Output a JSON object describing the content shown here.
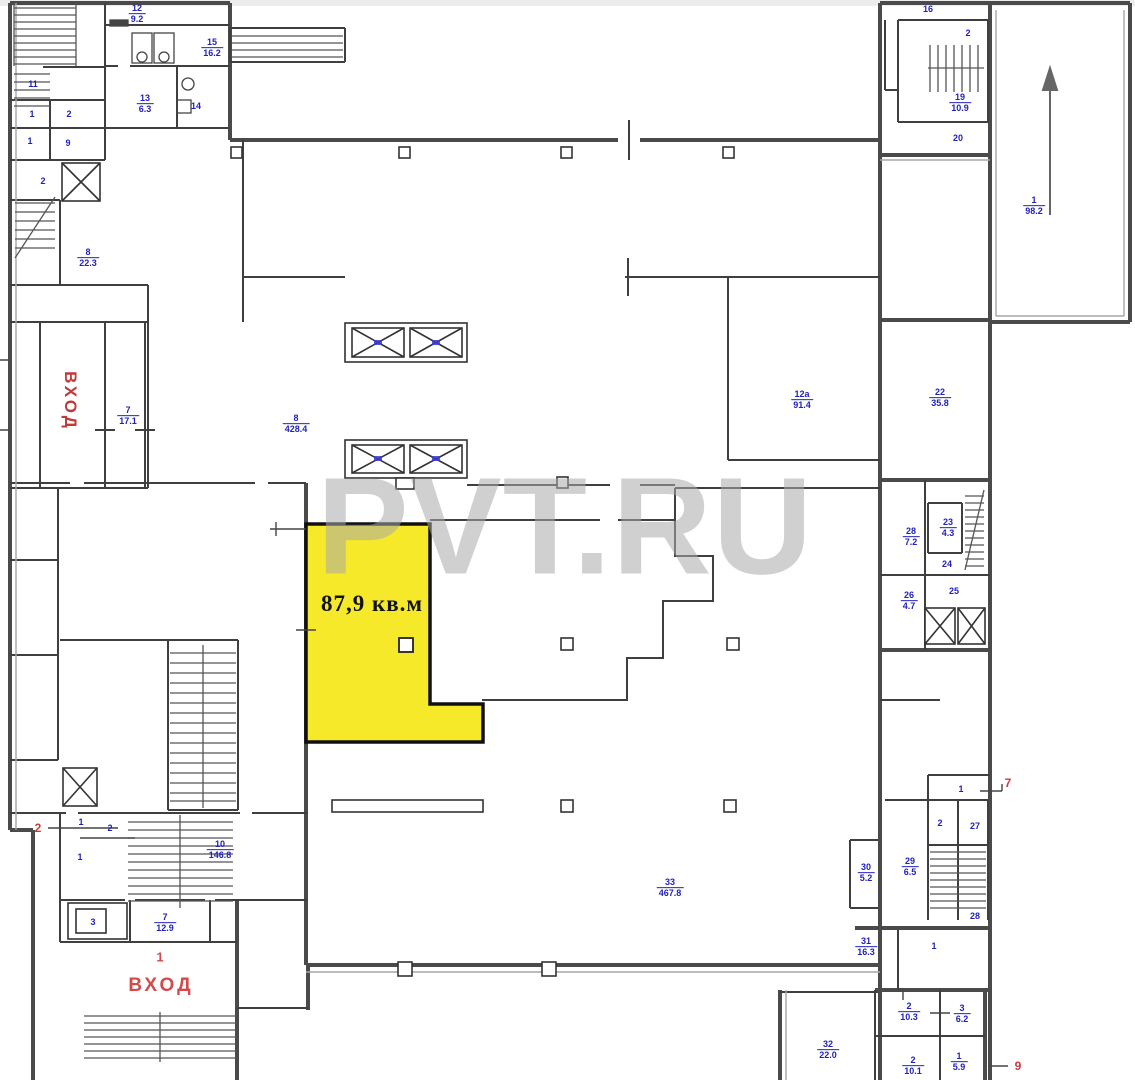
{
  "watermark": {
    "text": "PVT.RU"
  },
  "unit": {
    "area_label": "87,9 кв.м"
  },
  "entrances": {
    "side_label": "ВХОД",
    "main_number": "1",
    "main_label": "ВХОД"
  },
  "colors": {
    "highlight_yellow": "#f5e929",
    "label_blue": "#2222bb",
    "marker_red": "#cc3b3b",
    "wall_dark": "#3f3f3f",
    "watermark_gray": "#aaaaaa"
  },
  "room_labels": [
    {
      "number": "11",
      "area": "",
      "x": 33,
      "y": 84
    },
    {
      "number": "1",
      "area": "",
      "x": 32,
      "y": 114
    },
    {
      "number": "2",
      "area": "",
      "x": 69,
      "y": 114
    },
    {
      "number": "1",
      "area": "",
      "x": 30,
      "y": 141
    },
    {
      "number": "9",
      "area": "",
      "x": 68,
      "y": 143
    },
    {
      "number": "2",
      "area": "",
      "x": 43,
      "y": 181
    },
    {
      "number": "8",
      "area": "22.3",
      "x": 88,
      "y": 258
    },
    {
      "number": "12",
      "area": "9.2",
      "x": 137,
      "y": 14
    },
    {
      "number": "15",
      "area": "16.2",
      "x": 212,
      "y": 48
    },
    {
      "number": "13",
      "area": "6.3",
      "x": 145,
      "y": 104
    },
    {
      "number": "14",
      "area": "",
      "x": 196,
      "y": 106
    },
    {
      "number": "7",
      "area": "17.1",
      "x": 128,
      "y": 416
    },
    {
      "number": "8",
      "area": "428.4",
      "x": 296,
      "y": 424
    },
    {
      "number": "12а",
      "area": "91.4",
      "x": 802,
      "y": 400
    },
    {
      "number": "22",
      "area": "35.8",
      "x": 940,
      "y": 398
    },
    {
      "number": "16",
      "area": "",
      "x": 928,
      "y": 9
    },
    {
      "number": "2",
      "area": "",
      "x": 968,
      "y": 33
    },
    {
      "number": "19",
      "area": "10.9",
      "x": 960,
      "y": 103
    },
    {
      "number": "20",
      "area": "",
      "x": 958,
      "y": 138
    },
    {
      "number": "1",
      "area": "98.2",
      "x": 1034,
      "y": 206
    },
    {
      "number": "28",
      "area": "7.2",
      "x": 911,
      "y": 537
    },
    {
      "number": "23",
      "area": "4.3",
      "x": 948,
      "y": 528
    },
    {
      "number": "24",
      "area": "",
      "x": 947,
      "y": 564
    },
    {
      "number": "25",
      "area": "",
      "x": 954,
      "y": 591
    },
    {
      "number": "26",
      "area": "4.7",
      "x": 909,
      "y": 601
    },
    {
      "number": "1",
      "area": "",
      "x": 961,
      "y": 789
    },
    {
      "number": "2",
      "area": "",
      "x": 940,
      "y": 823
    },
    {
      "number": "27",
      "area": "",
      "x": 975,
      "y": 826
    },
    {
      "number": "29",
      "area": "6.5",
      "x": 910,
      "y": 867
    },
    {
      "number": "30",
      "area": "5.2",
      "x": 866,
      "y": 873
    },
    {
      "number": "28",
      "area": "",
      "x": 975,
      "y": 916
    },
    {
      "number": "31",
      "area": "16.3",
      "x": 866,
      "y": 947
    },
    {
      "number": "1",
      "area": "",
      "x": 934,
      "y": 946
    },
    {
      "number": "2",
      "area": "10.3",
      "x": 909,
      "y": 1012
    },
    {
      "number": "3",
      "area": "6.2",
      "x": 962,
      "y": 1014
    },
    {
      "number": "2",
      "area": "10.1",
      "x": 913,
      "y": 1066
    },
    {
      "number": "1",
      "area": "5.9",
      "x": 959,
      "y": 1062
    },
    {
      "number": "32",
      "area": "22.0",
      "x": 828,
      "y": 1050
    },
    {
      "number": "33",
      "area": "467.8",
      "x": 670,
      "y": 888
    },
    {
      "number": "10",
      "area": "146.8",
      "x": 220,
      "y": 850
    },
    {
      "number": "1",
      "area": "",
      "x": 81,
      "y": 822
    },
    {
      "number": "2",
      "area": "",
      "x": 110,
      "y": 828
    },
    {
      "number": "1",
      "area": "",
      "x": 80,
      "y": 857
    },
    {
      "number": "3",
      "area": "",
      "x": 93,
      "y": 922
    },
    {
      "number": "7",
      "area": "12.9",
      "x": 165,
      "y": 923
    }
  ],
  "red_markers": [
    {
      "text": "2",
      "x": 38,
      "y": 828
    },
    {
      "text": "7",
      "x": 1008,
      "y": 783
    },
    {
      "text": "9",
      "x": 1018,
      "y": 1066
    }
  ]
}
